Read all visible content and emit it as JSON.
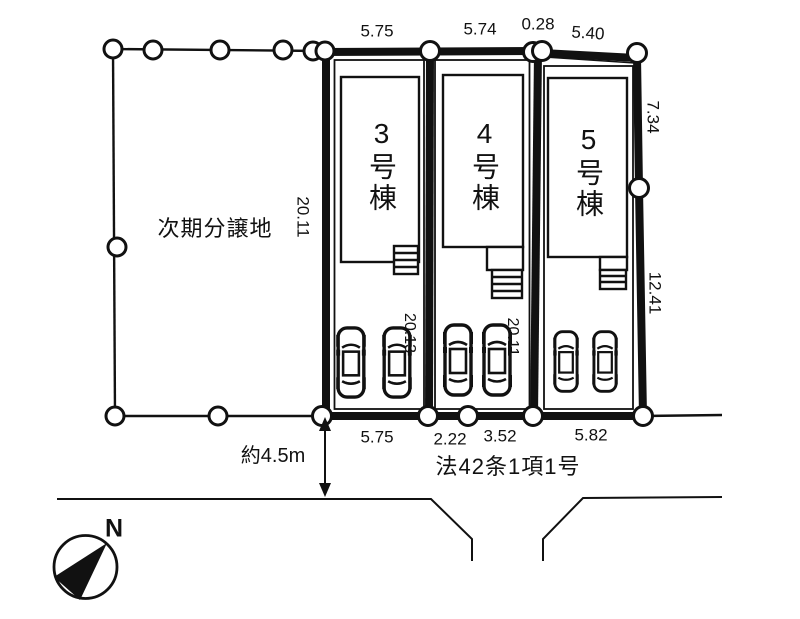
{
  "plan": {
    "adjacent_label": "次期分譲地",
    "road_law_label": "法42条1項1号",
    "road_width_label": "約4.5m",
    "compass_n": "N",
    "lots": [
      {
        "name": "3号棟",
        "depth": "20.13"
      },
      {
        "name": "4号棟",
        "depth": "20.11"
      },
      {
        "name": "5号棟"
      }
    ],
    "dims": {
      "top_1": "5.75",
      "top_2": "5.74",
      "top_3": "0.28",
      "top_4": "5.40",
      "left": "20.11",
      "right_upper": "7.34",
      "right_lower": "12.41",
      "bottom_1": "5.75",
      "bottom_2": "2.22",
      "bottom_3": "3.52",
      "bottom_4": "5.82"
    },
    "colors": {
      "line": "#111111",
      "background": "#ffffff"
    }
  }
}
